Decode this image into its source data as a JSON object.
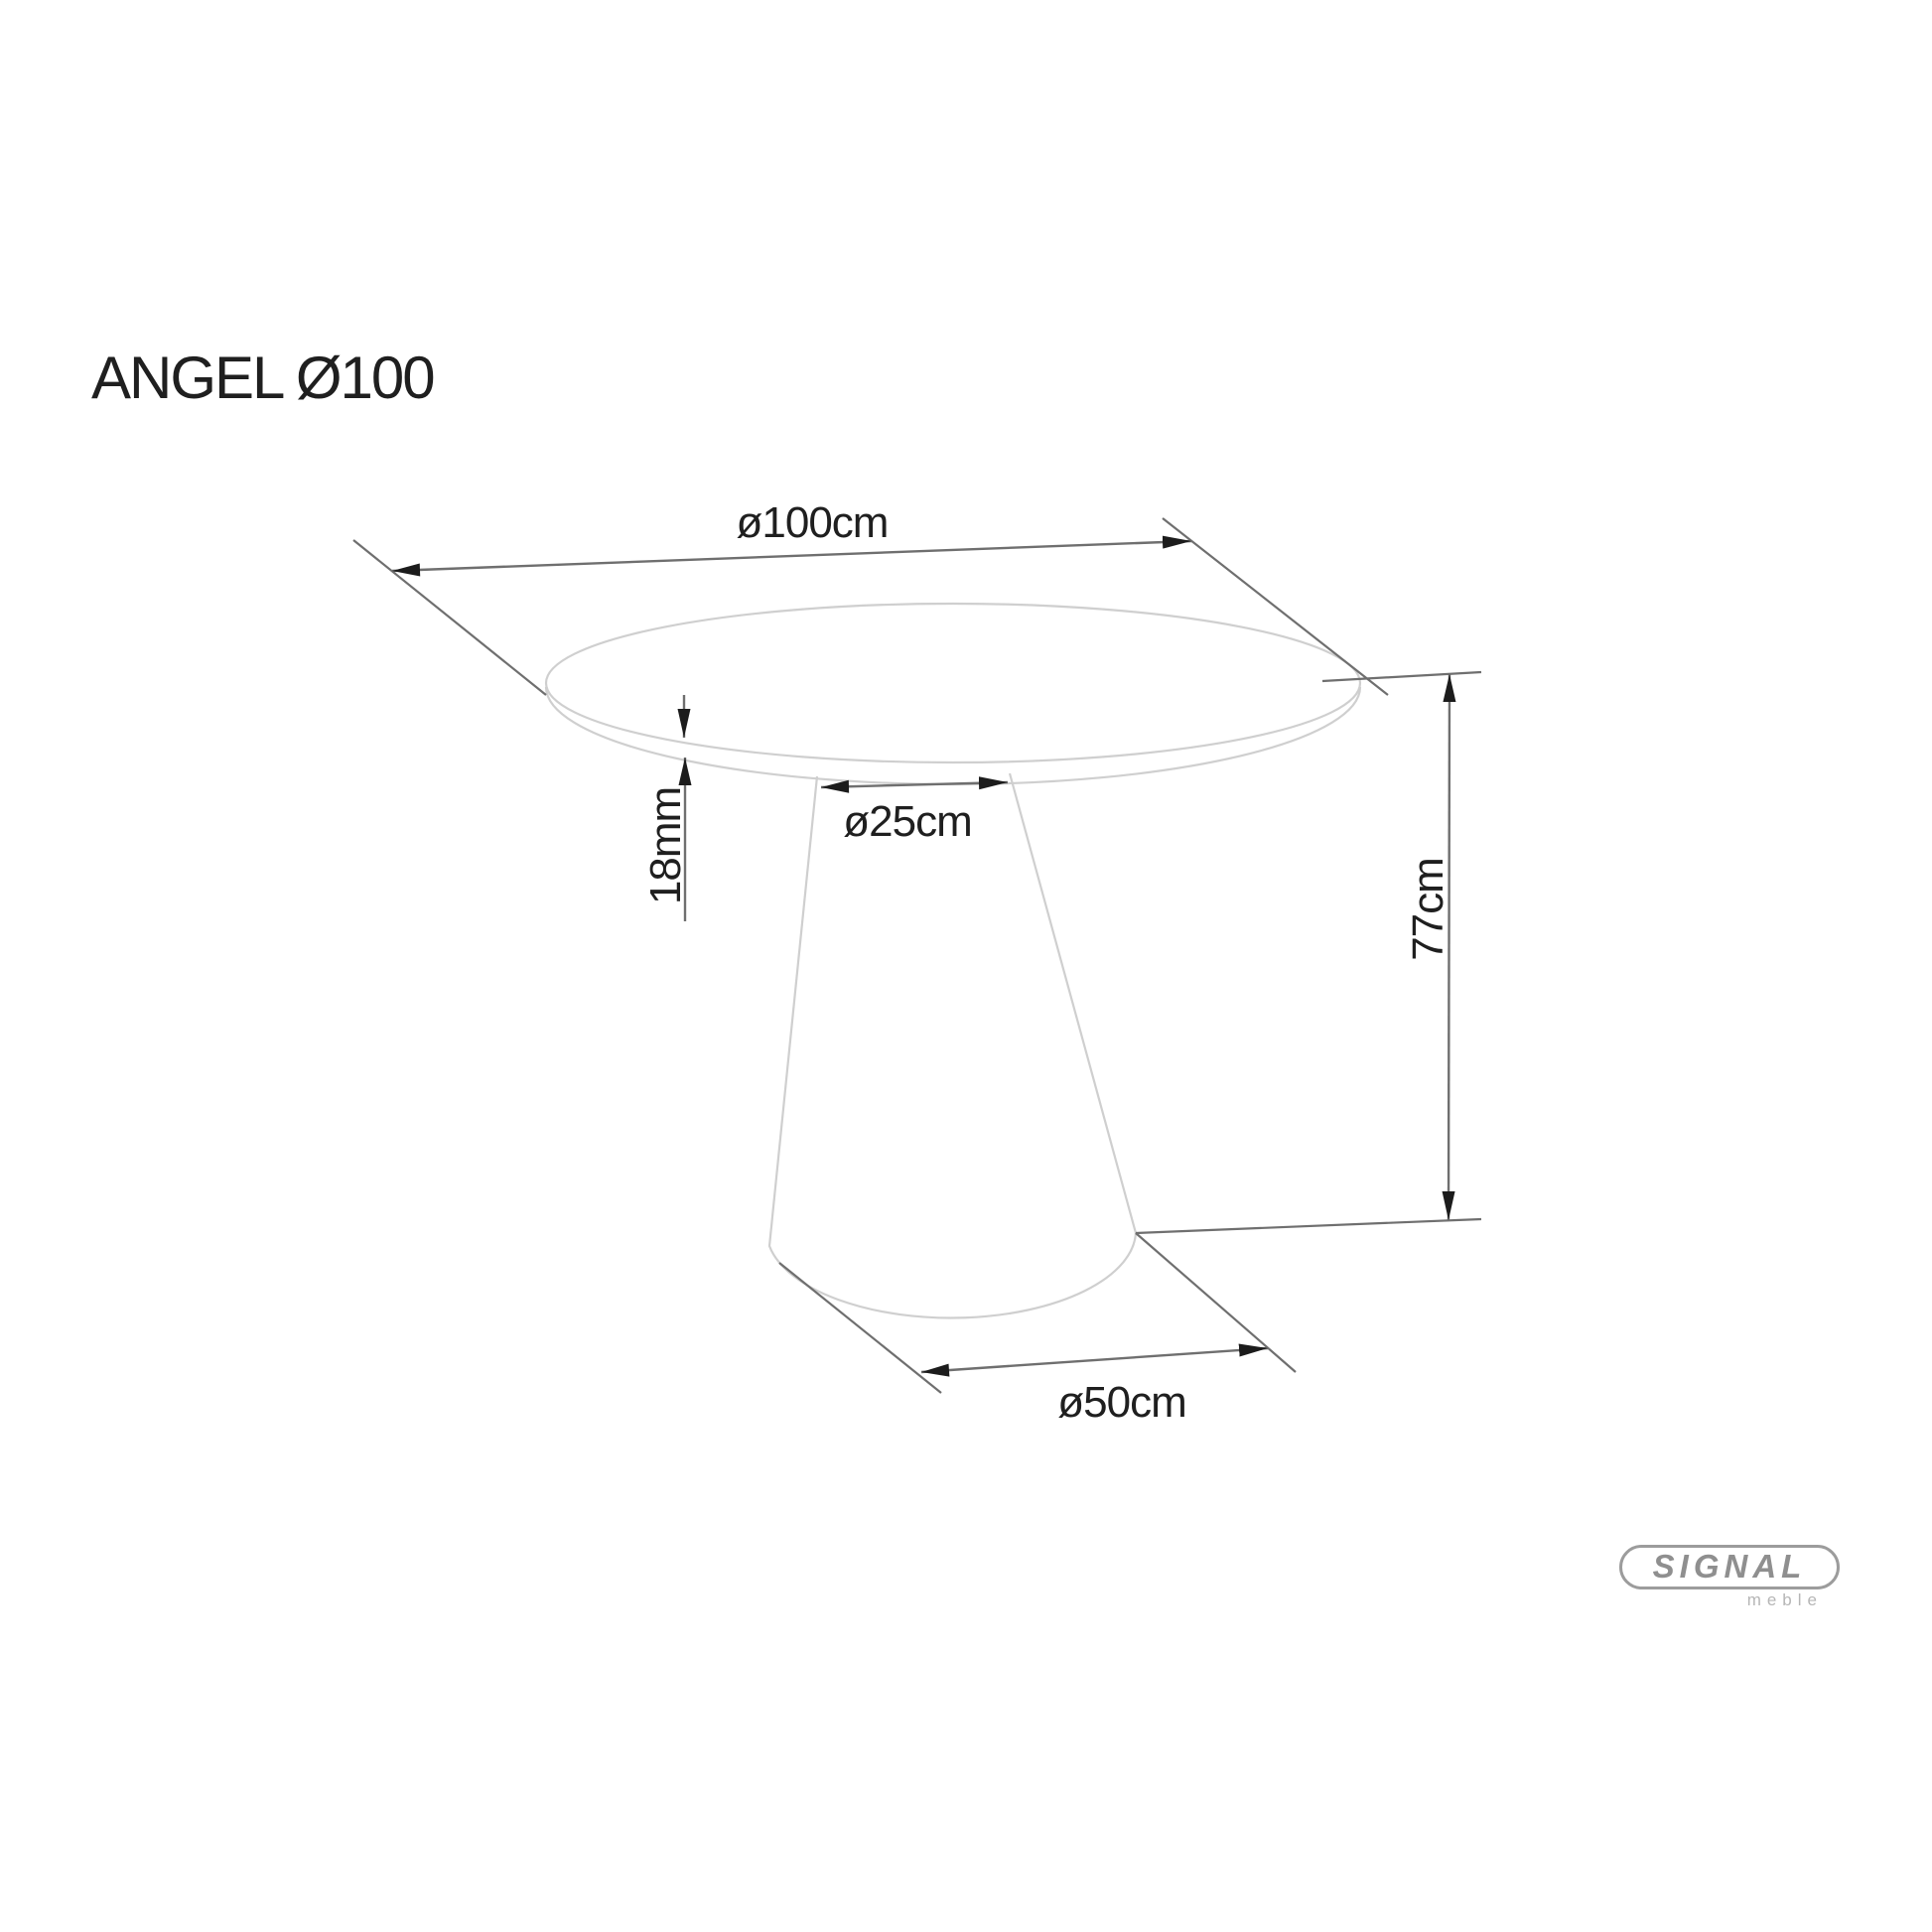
{
  "title": "ANGEL Ø100",
  "drawing": {
    "product": "round pedestal table, side view technical drawing",
    "labels": {
      "top_diameter": "ø100cm",
      "column_diameter": "ø25cm",
      "top_thickness": "18mm",
      "height": "77cm",
      "base_diameter": "ø50cm"
    }
  },
  "logo": {
    "brand": "SIGNAL",
    "subtitle": "meble"
  },
  "colors": {
    "background": "#ffffff",
    "outline_gray": "#cfcfcf",
    "dimension_gray": "#6f6f6f",
    "arrow_black": "#1c1c1c",
    "text_black": "#1f1f1f",
    "logo_gray": "#8f8f8f",
    "logo_light_gray": "#b6b6b6",
    "logo_border": "#9c9c9c"
  }
}
